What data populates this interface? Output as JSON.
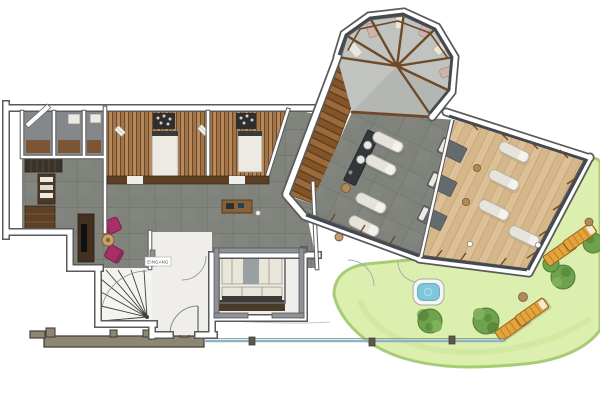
{
  "document": {
    "type": "floor-plan",
    "entrance_label": "EINGANG"
  },
  "palette": {
    "wallEdge": "#5a5a5a",
    "wallFill": "#ffffff",
    "grayWall": "#8f9294",
    "hallFloor": "#7f837b",
    "hallGrout": "#6f736b",
    "smallRoomFloor": "#85888a",
    "saunaWoodA": "#a5754a",
    "saunaWoodB": "#6e4a2c",
    "saunaWoodC": "#b98a5c",
    "benchWhite": "#eceae3",
    "heaterDark": "#2e2e2e",
    "deckWood": "#9a6a3a",
    "deckWoodDark": "#825428",
    "deckLine": "#5d3b1d",
    "conservatoryFloor": "#c0c3bf",
    "glassDark": "#424950",
    "timber": "#6f4a26",
    "relaxFloor": "#ddc096",
    "relaxLine": "#c6a87c",
    "loungerWhite": "#e6e3da",
    "loungerEdge": "#b0aca0",
    "matGray": "#646a6e",
    "counterDark": "#33373a",
    "tvBrown": "#43301f",
    "chairMagenta": "#a93067",
    "tableWood": "#b08a58",
    "stairWhite": "#f4f3f0",
    "closetCream": "#e9e5d8",
    "gardenGreen": "#dcefae",
    "gardenEdge": "#a8cc74",
    "bushGreen": "#6fa24c",
    "bushDark": "#4e7c33",
    "sunLounger": "#e4a33d",
    "sunLoungerLine": "#b97f24",
    "sunLoungerEdge": "#8a5c1c",
    "poolBlue": "#7fc6d9",
    "sketchWall": "#8d8673",
    "sketchLine": "#47423a",
    "sketchBlue": "#8fb3c2"
  },
  "plan": {
    "rooms": [
      {
        "id": "sauna-1"
      },
      {
        "id": "sauna-2"
      },
      {
        "id": "shower-room-1"
      },
      {
        "id": "shower-room-2"
      },
      {
        "id": "shower-room-3"
      },
      {
        "id": "changing-room"
      },
      {
        "id": "lounge-area"
      },
      {
        "id": "stairs"
      },
      {
        "id": "entrance-corridor",
        "label": "EINGANG"
      },
      {
        "id": "wardrobe-room"
      },
      {
        "id": "hall"
      },
      {
        "id": "winter-garden"
      },
      {
        "id": "spa-room"
      },
      {
        "id": "relax-room"
      },
      {
        "id": "deck"
      },
      {
        "id": "garden"
      }
    ],
    "furniture_counts": {
      "sauna_benches": 2,
      "sauna_heaters": 2,
      "spa_loungers": 4,
      "relax_loungers": 4,
      "massage_mats": 3,
      "garden_loungers": 4,
      "bushes": 5,
      "armchairs": 2,
      "bar_counter": 1,
      "whirlpool": 1,
      "conservatory_cushions": 6
    }
  }
}
